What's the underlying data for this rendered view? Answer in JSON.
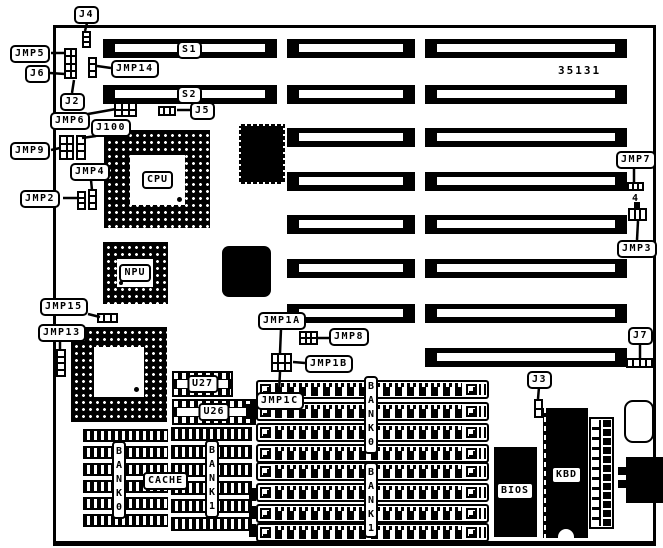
{
  "diagram": {
    "part_number": "35131",
    "slots": {
      "s1": "S1",
      "s2": "S2"
    },
    "chips": {
      "cpu": "CPU",
      "npu": "NPU",
      "u27": "U27",
      "u26": "U26",
      "cache": "CACHE",
      "bios": "BIOS",
      "kbd": "KBD"
    },
    "banks": {
      "cache_bank0": "BANK0",
      "cache_bank1": "BANK1",
      "simm_bank0": "BANK0",
      "simm_bank1": "BANK1"
    },
    "callouts": {
      "j4": "J4",
      "jmp5": "JMP5",
      "j6": "J6",
      "jmp14": "JMP14",
      "j2": "J2",
      "jmp6": "JMP6",
      "j100": "J100",
      "j5": "J5",
      "jmp9": "JMP9",
      "jmp4": "JMP4",
      "jmp2": "JMP2",
      "jmp15": "JMP15",
      "jmp13": "JMP13",
      "jmp1a": "JMP1A",
      "jmp8": "JMP8",
      "jmp1b": "JMP1B",
      "jmp1c": "JMP1C",
      "jmp7": "JMP7",
      "pin4": "4",
      "jmp3": "JMP3",
      "j7": "J7",
      "j3": "J3"
    }
  }
}
